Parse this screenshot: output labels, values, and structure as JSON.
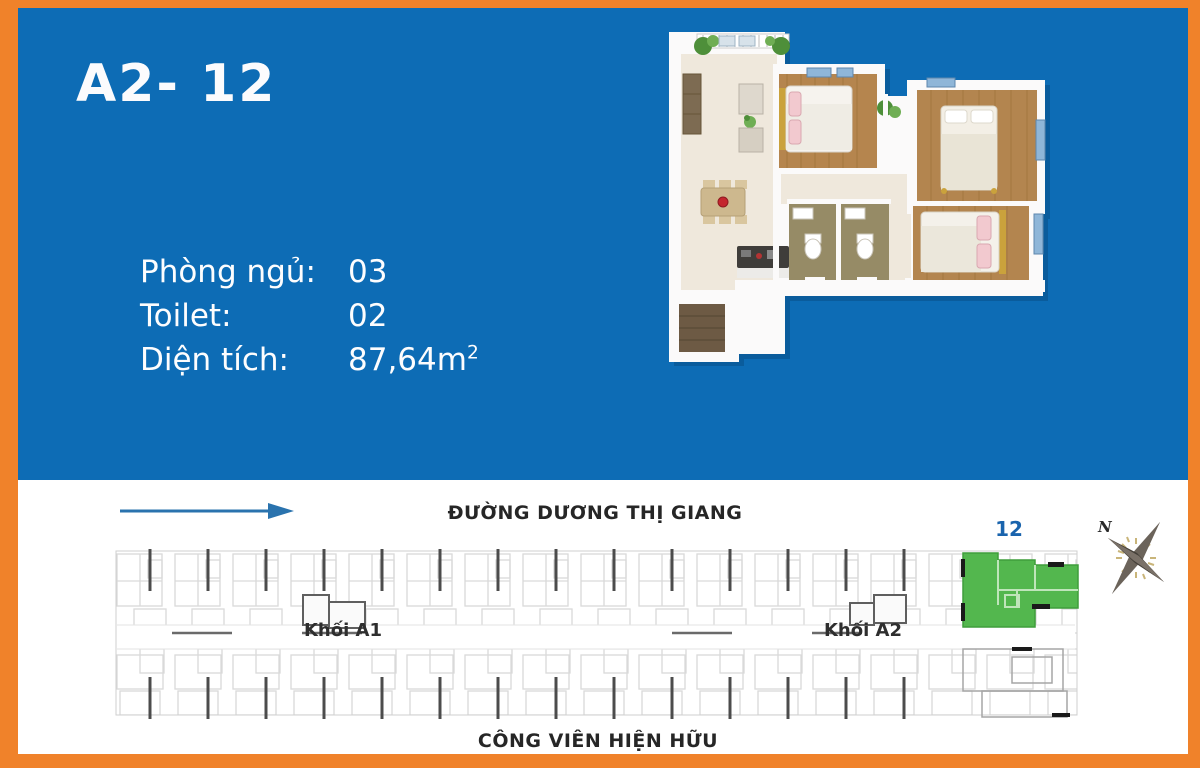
{
  "colors": {
    "background_blue": "#0d6cb5",
    "frame_orange": "#f0822a",
    "highlight_green": "#53b74e",
    "unit_number_blue": "#1a64ad",
    "text_dark": "#262626",
    "text_white": "#fdfdfe"
  },
  "header": {
    "unit_code": "A2- 12"
  },
  "specs": [
    {
      "label": "Phòng ngủ:",
      "value": "03"
    },
    {
      "label": "Toilet:",
      "value": "02"
    },
    {
      "label": "Diện tích:",
      "value": "87,64m",
      "sup": "2"
    }
  ],
  "site_plan": {
    "road_label": "ĐƯỜNG DƯƠNG THỊ GIANG",
    "park_label": "CÔNG VIÊN HIỆN HỮU",
    "block_a1_label": "Khối A1",
    "block_a2_label": "Khối A2",
    "highlighted_unit_number": "12",
    "compass_north": "N"
  }
}
